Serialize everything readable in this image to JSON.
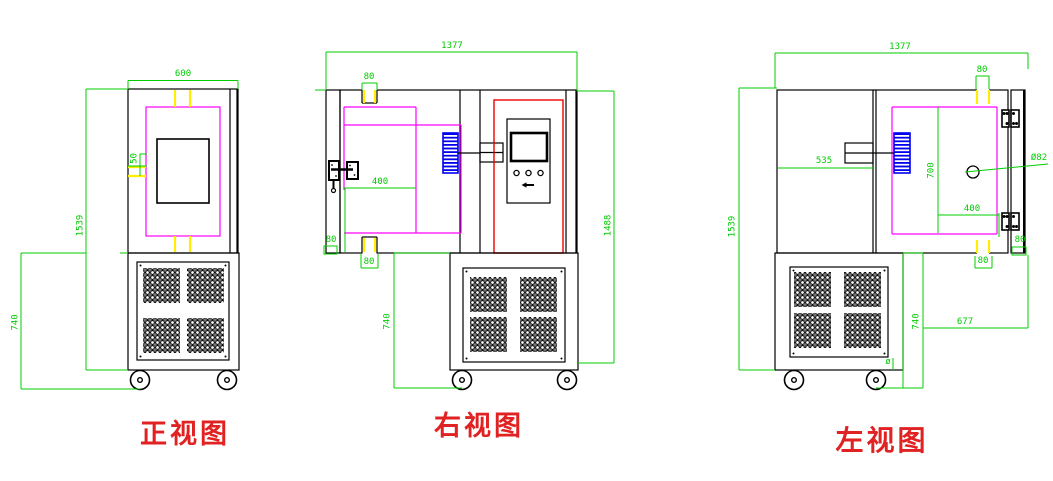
{
  "drawing": {
    "type": "CAD three-view engineering drawing of environmental test chamber",
    "colors": {
      "outline": "#000000",
      "dimension": "#00cc00",
      "inner_liner": "#ff00ff",
      "hinge_mark": "#ffff00",
      "panel_frame": "#ee0000",
      "fan": "#0000ee",
      "view_label": "#e02222",
      "background": "#ffffff"
    },
    "views": {
      "front": {
        "label": "正视图",
        "dims": {
          "top_width": "600",
          "total_height": "1539",
          "base_height": "740",
          "window_offset": "50"
        }
      },
      "right_side": {
        "label": "右视图",
        "dims": {
          "top_width": "1377",
          "top_hinge": "80",
          "door_edge": "80",
          "bottom_hinge": "80",
          "inner_width": "400",
          "right_height": "1488",
          "base_height": "740"
        }
      },
      "left_side": {
        "label": "左视图",
        "dims": {
          "top_width": "1377",
          "top_hinge": "80",
          "machine_depth": "535",
          "chamber_height": "700",
          "port_diameter": "Ø82",
          "inner_width": "400",
          "corner": "80",
          "bottom_hinge": "80",
          "total_height": "1539",
          "base_height": "740",
          "base_offset": "677",
          "port_mark": "ø"
        }
      }
    }
  }
}
